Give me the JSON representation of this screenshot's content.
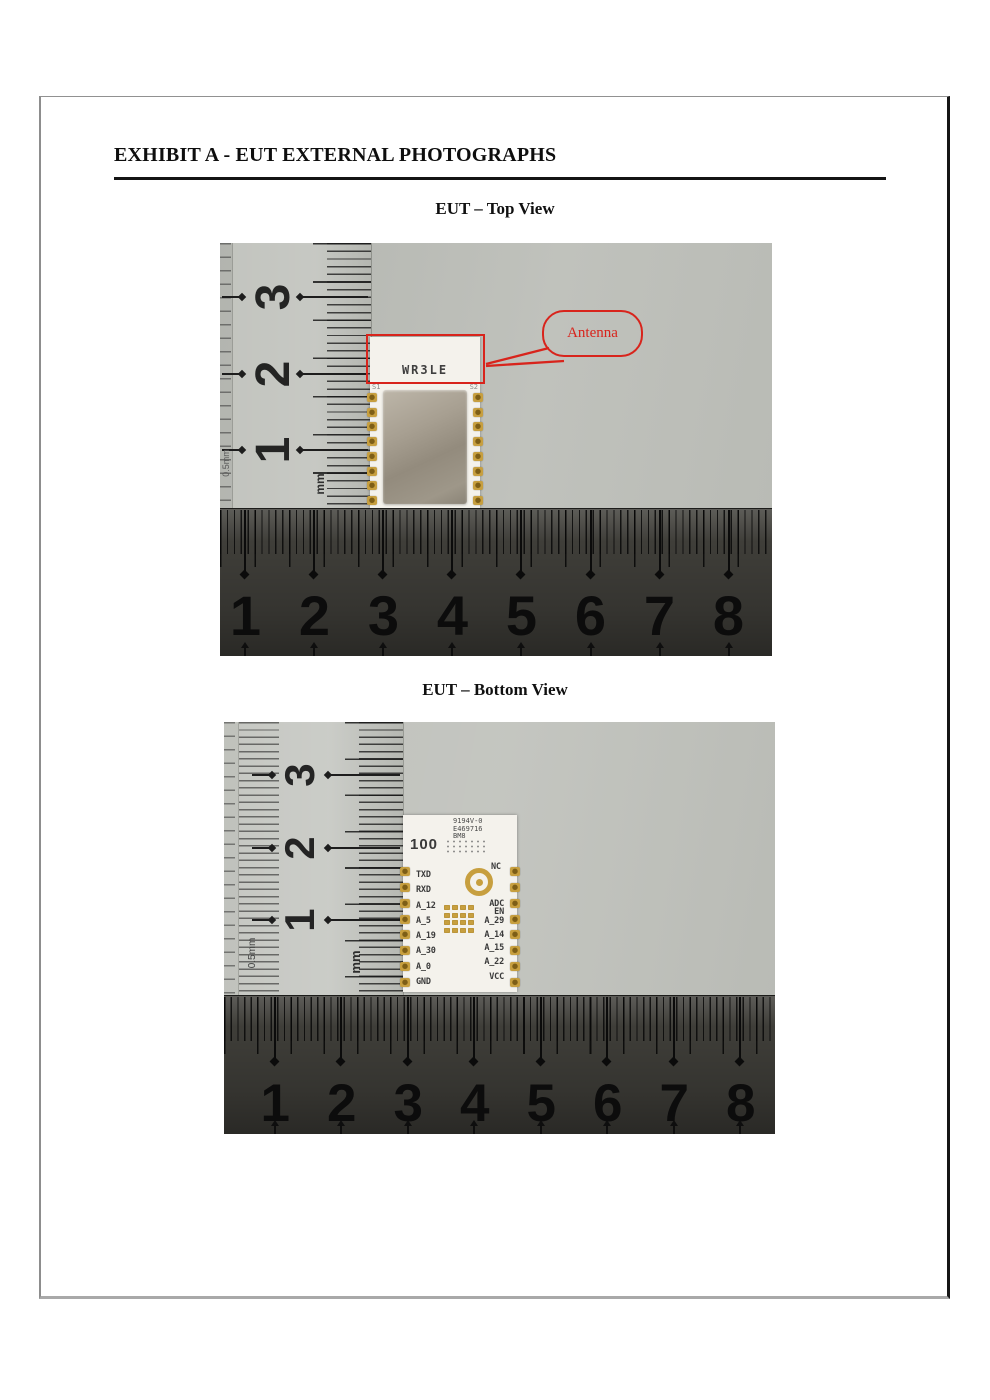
{
  "page": {
    "title": "EXHIBIT A - EUT EXTERNAL PHOTOGRAPHS",
    "top_section_heading": "EUT – Top View",
    "bottom_section_heading": "EUT – Bottom View"
  },
  "colors": {
    "annotation_red": "#d8241c",
    "pad_gold": "#c79f3f",
    "pcb_white": "#f4f2ec",
    "plate_gray": "#bcbeb8",
    "ruler_dark": "#3f3e39"
  },
  "top_photo": {
    "vertical_ruler": {
      "numbers": [
        "3",
        "2",
        "1"
      ],
      "unit_label": "mm",
      "edge_label": "0.5mm"
    },
    "horizontal_ruler": {
      "numbers": [
        "1",
        "2",
        "3",
        "4",
        "5",
        "6",
        "7",
        "8"
      ]
    },
    "module": {
      "silkscreen_label": "WR3LE",
      "corner_label_left": "S1",
      "corner_label_right": "S2"
    },
    "callout_label": "Antenna"
  },
  "bottom_photo": {
    "vertical_ruler": {
      "numbers": [
        "3",
        "2",
        "1"
      ],
      "unit_label": "mm",
      "edge_label": "0.5mm"
    },
    "horizontal_ruler": {
      "numbers": [
        "1",
        "2",
        "3",
        "4",
        "5",
        "6",
        "7",
        "8"
      ],
      "corner_label": "5mm"
    },
    "pcb": {
      "markings": [
        "9194V-0",
        "E469716",
        "BM8"
      ],
      "big_label": "100",
      "top_right_pin": "NC",
      "left_pins": [
        "TXD",
        "RXD",
        "A_12",
        "A_5",
        "A_19",
        "A_30",
        "A_0",
        "GND"
      ],
      "right_pins": [
        "ADC",
        "EN",
        "A_29",
        "A_14",
        "A_15",
        "A_22",
        "VCC"
      ]
    }
  }
}
